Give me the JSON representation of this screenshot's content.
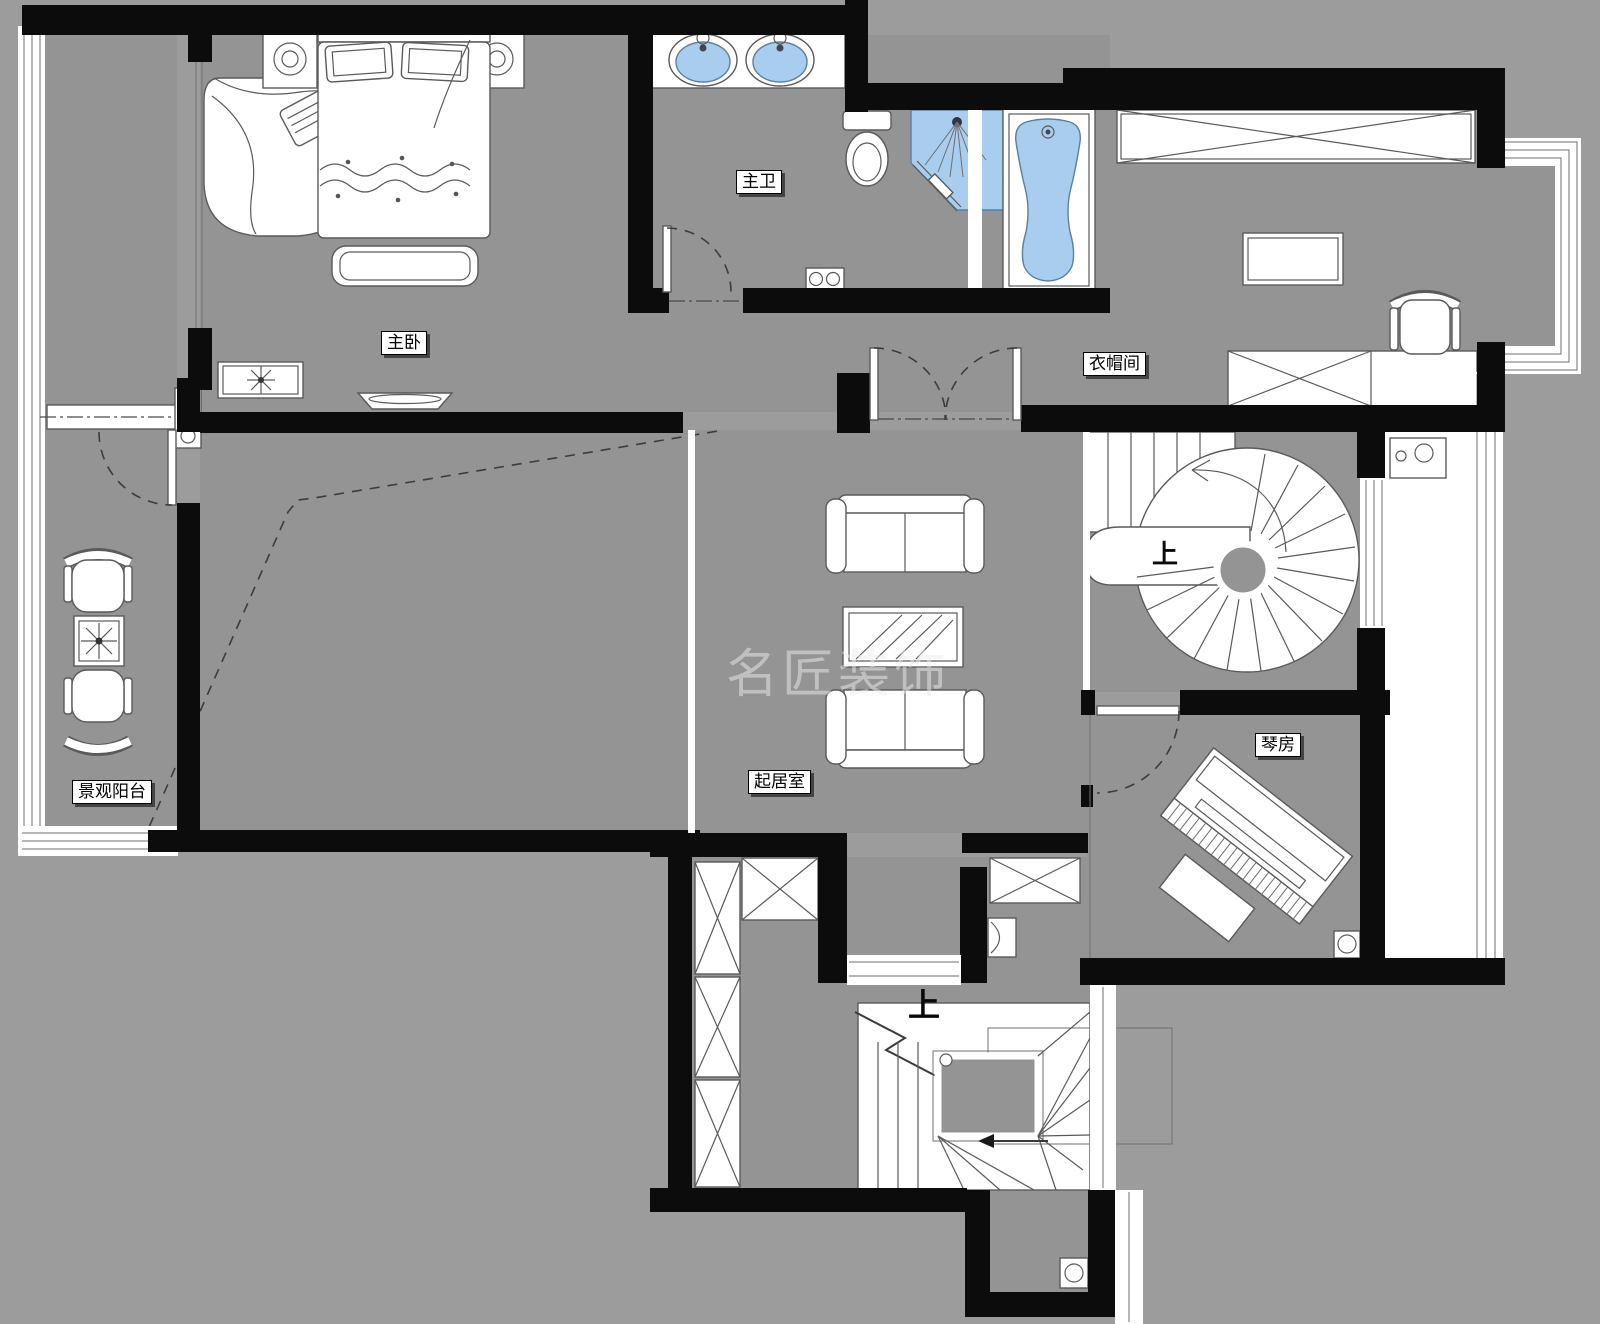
{
  "plan": {
    "watermark": "名匠装饰",
    "rooms": [
      {
        "id": "master-bedroom",
        "label": "主卧"
      },
      {
        "id": "master-bath",
        "label": "主卫"
      },
      {
        "id": "cloakroom",
        "label": "衣帽间"
      },
      {
        "id": "living-room",
        "label": "起居室"
      },
      {
        "id": "piano-room",
        "label": "琴房"
      },
      {
        "id": "view-balcony",
        "label": "景观阳台"
      }
    ],
    "stairs": [
      {
        "id": "spiral-stair",
        "label": "上"
      },
      {
        "id": "lower-stair",
        "label": "上"
      }
    ],
    "colors": {
      "bg": "#9c9c9c",
      "floor": "#949494",
      "wall": "#0c0c0c",
      "blue": "#a9cdee"
    }
  }
}
